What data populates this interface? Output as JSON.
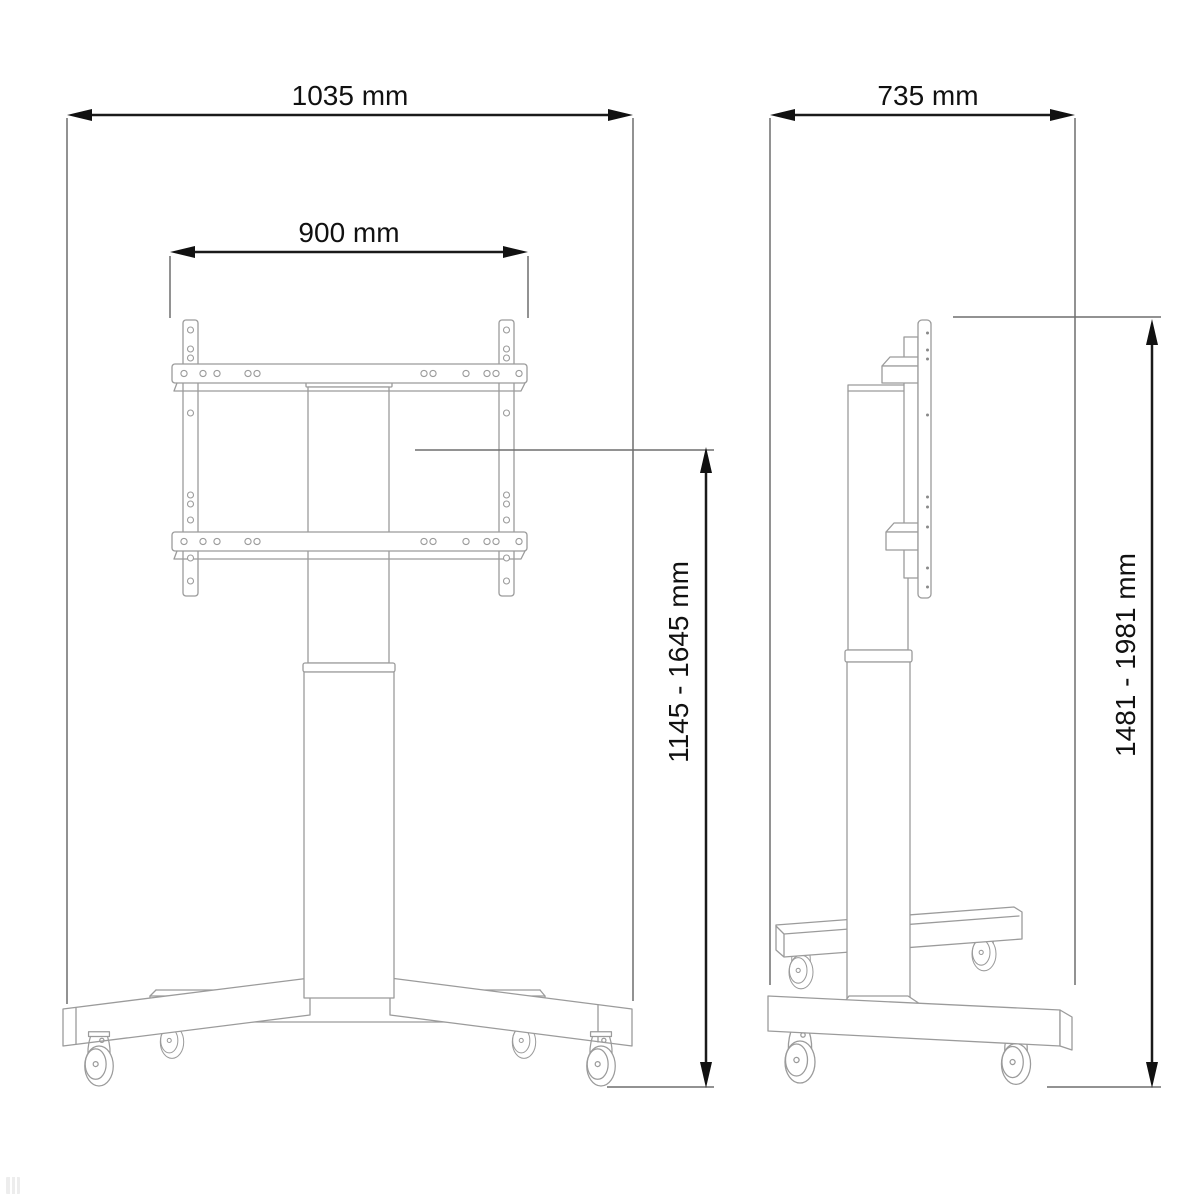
{
  "diagram": {
    "front_view": {
      "overall_width": "1035 mm",
      "mount_width": "900 mm",
      "height_range": "1145 - 1645 mm"
    },
    "side_view": {
      "depth": "735 mm",
      "total_height_range": "1481 - 1981 mm"
    },
    "unit": "mm",
    "colors": {
      "dimension_line": "#1a1a1a",
      "extension_line": "#6e6e6e",
      "artwork_line": "#9b9b9b",
      "background": "#ffffff"
    }
  }
}
